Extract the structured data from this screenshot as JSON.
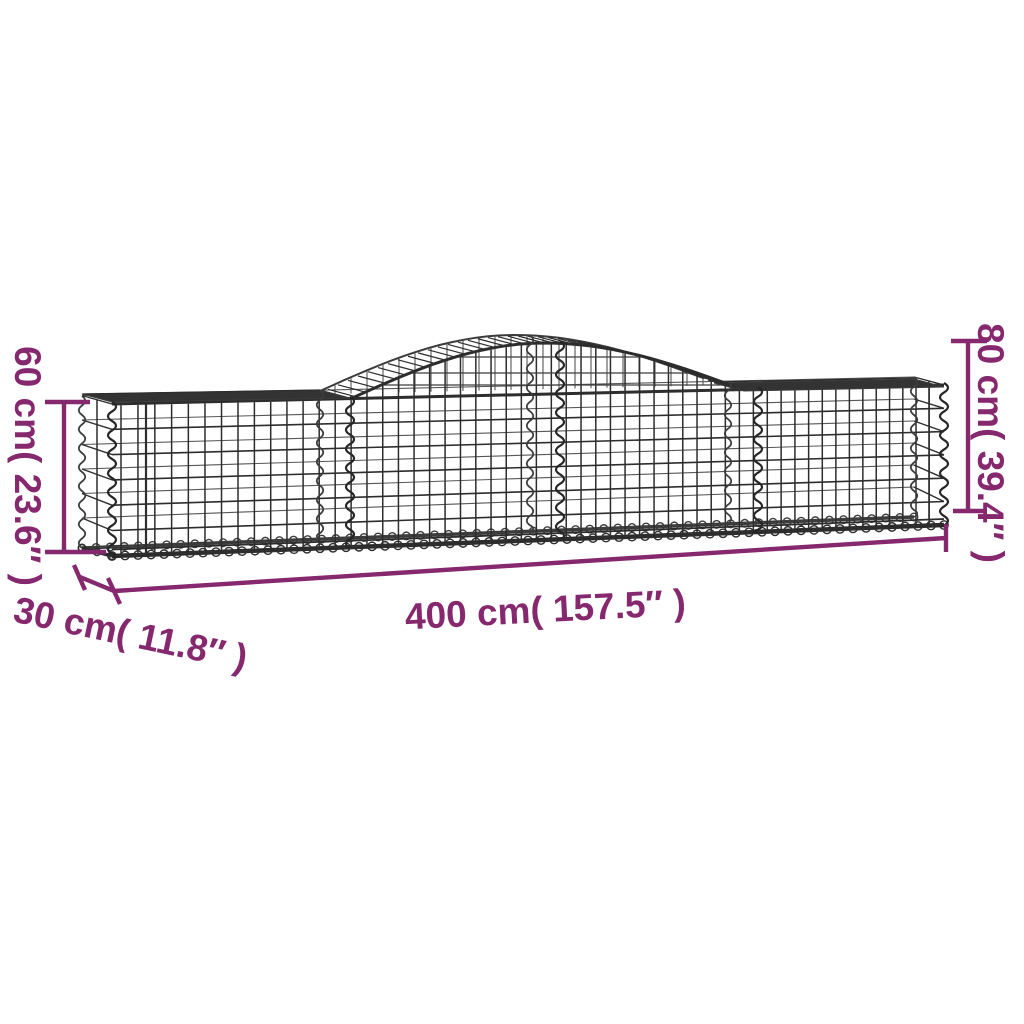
{
  "diagram": {
    "type": "product-dimension-diagram",
    "subject": "arched gabion wire-mesh basket",
    "dimensions": {
      "height_left": {
        "label": "60 cm( 23.6″ )",
        "cm": "60",
        "inches": "23.6"
      },
      "height_right": {
        "label": "80 cm( 39.4″ )",
        "cm": "80",
        "inches": "39.4"
      },
      "length": {
        "label": "400 cm( 157.5″ )",
        "cm": "400",
        "inches": "157.5"
      },
      "depth": {
        "label": "30 cm( 11.8″ )",
        "cm": "30",
        "inches": "11.8"
      }
    },
    "colors": {
      "dimension_accent": "#86286E",
      "wire_dark": "#2d2d2d",
      "wire_mid": "#3c3c3c",
      "wire_light": "#575757",
      "background": "#ffffff"
    }
  }
}
